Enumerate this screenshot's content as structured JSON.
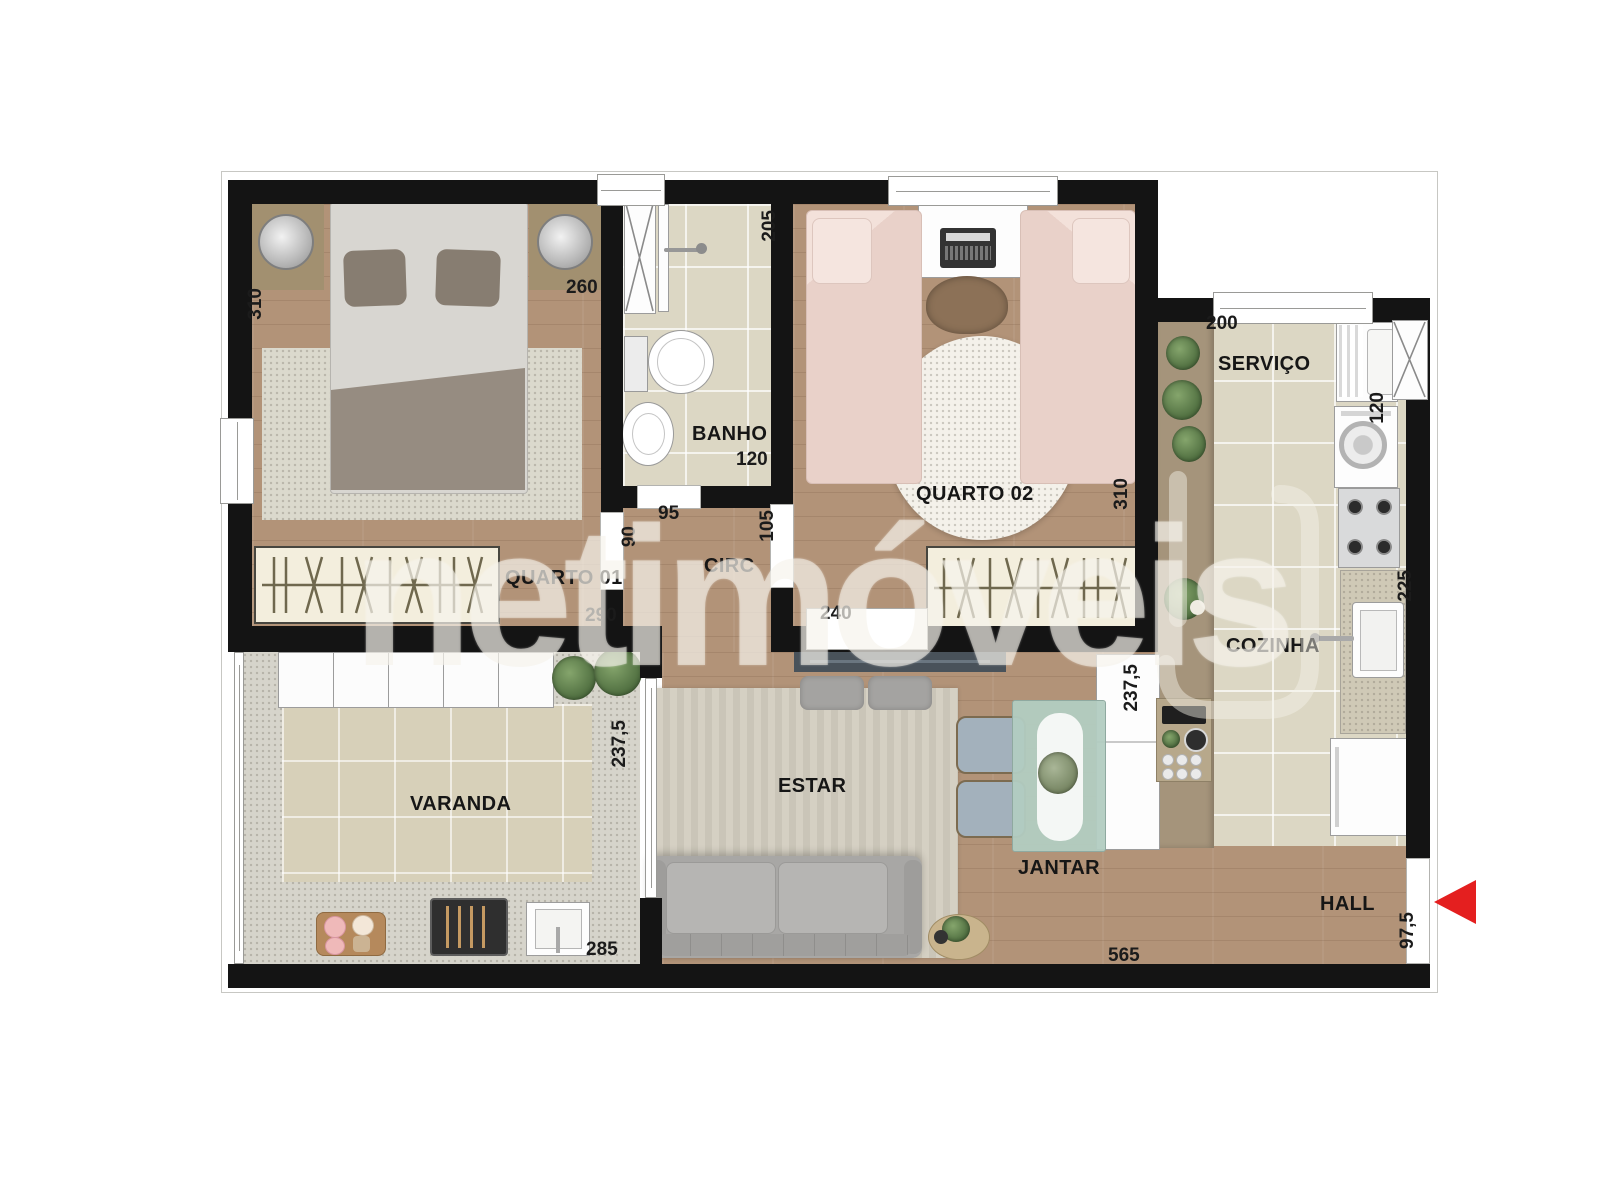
{
  "plan": {
    "watermark_text": "netimóveis",
    "rooms": {
      "quarto01": "QUARTO 01",
      "banho": "BANHO",
      "circ": "CIRC",
      "quarto02": "QUARTO 02",
      "servico": "SERVIÇO",
      "cozinha": "COZINHA",
      "varanda": "VARANDA",
      "estar": "ESTAR",
      "jantar": "JANTAR",
      "hall": "HALL"
    },
    "dims": {
      "q1_side": "310",
      "q1_top": "260",
      "q1_inner": "290",
      "q1_door": "90",
      "banho_side": "205",
      "banho_bottom": "120",
      "banho_door": "95",
      "q2_door": "105",
      "q2_side": "310",
      "q2_inner": "240",
      "servico_top": "200",
      "servico_side": "120",
      "cozinha_side": "225",
      "counter_side": "237,5",
      "varanda_side": "237,5",
      "varanda_bottom": "285",
      "bottom_width": "565",
      "hall_side": "97,5"
    },
    "colors": {
      "wall": "#141414",
      "entry_arrow": "#e41f1f",
      "wood_floor": "#b29378",
      "tile_floor": "#dcd7c4"
    }
  }
}
